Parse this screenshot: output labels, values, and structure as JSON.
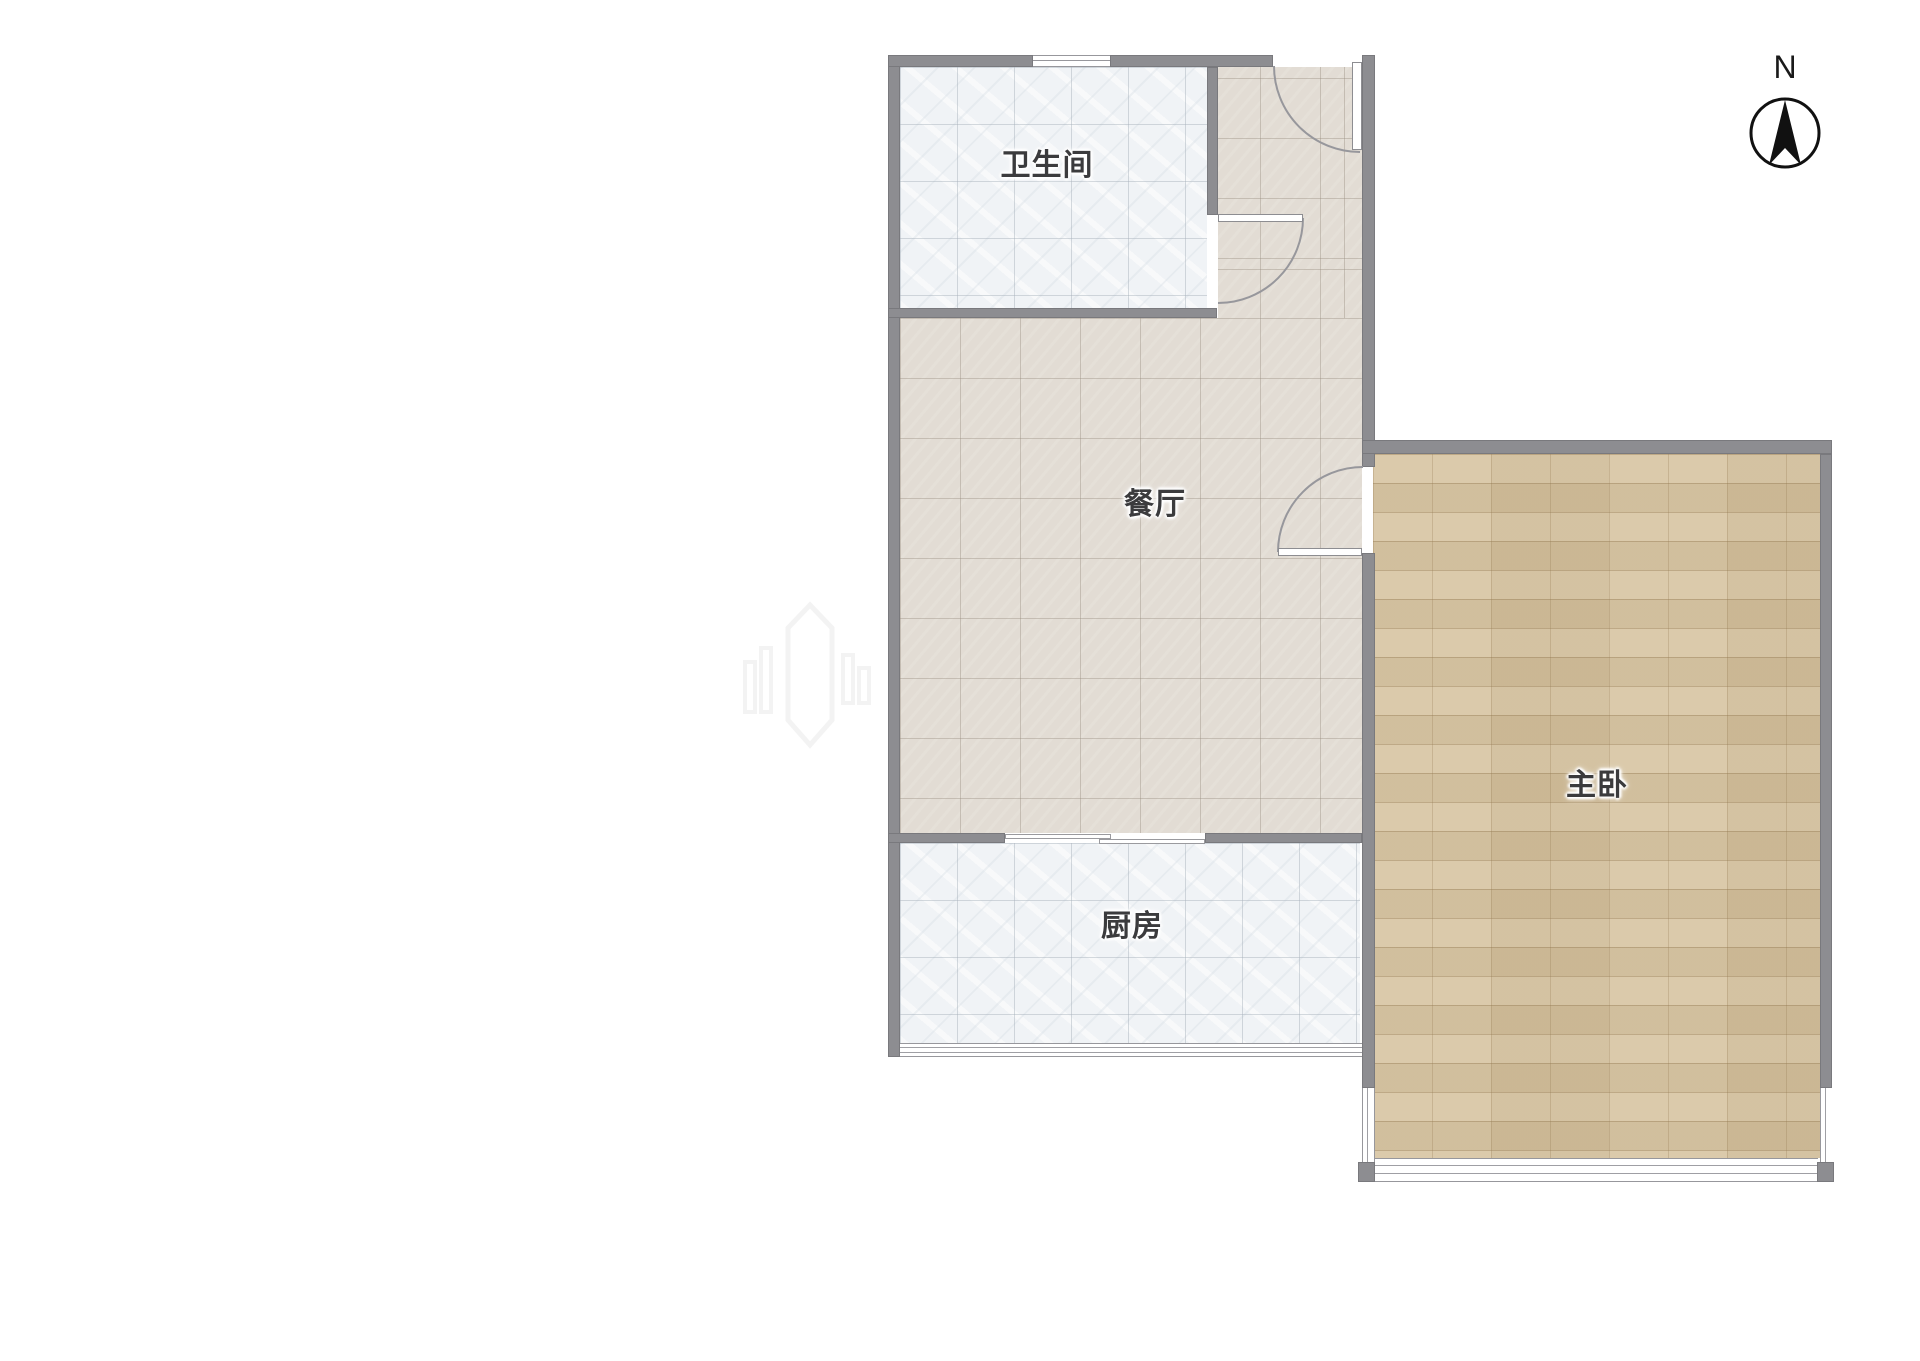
{
  "compass": {
    "label": "N"
  },
  "rooms": {
    "bathroom": {
      "label": "卫生间"
    },
    "dining": {
      "label": "餐厅"
    },
    "kitchen": {
      "label": "厨房"
    },
    "master_bedroom": {
      "label": "主卧"
    }
  },
  "colors": {
    "wall": "#8d8d91",
    "tile_floor": "#f0f3f6",
    "dining_floor": "#e2dcd4",
    "wood_floor": "#d6c3a0",
    "label_text": "#3b3b3d",
    "compass_ink": "#1a1a1a"
  }
}
